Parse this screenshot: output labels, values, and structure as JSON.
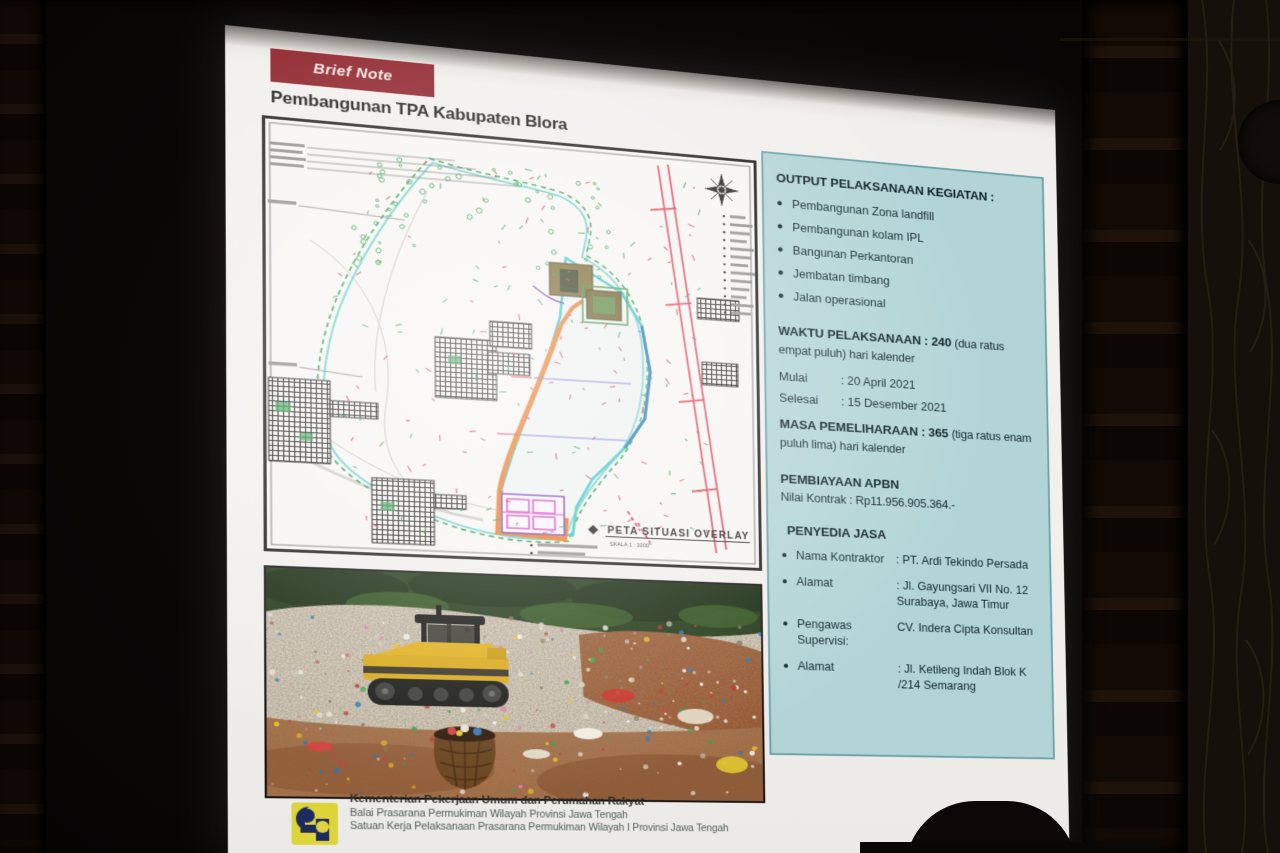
{
  "slide": {
    "badge_label": "Brief Note",
    "title": "Pembangunan TPA Kabupaten Blora",
    "map": {
      "caption": "PETA SITUASI OVERLAY",
      "scale": "SKALA 1 : 1000"
    },
    "panel": {
      "output": {
        "heading": "OUTPUT PELAKSANAAN KEGIATAN :",
        "items": [
          "Pembangunan Zona landfill",
          "Pembangunan kolam IPL",
          "Bangunan Perkantoran",
          "Jembatan timbang",
          "Jalan operasional"
        ]
      },
      "schedule": {
        "waktu_label": "WAKTU PELAKSANAAN :",
        "waktu_number": "240",
        "waktu_note": "(dua ratus empat puluh) hari kalender",
        "rows": [
          {
            "label": "Mulai",
            "value": ": 20 April 2021"
          },
          {
            "label": "Selesai",
            "value": ": 15 Desember 2021"
          }
        ],
        "masa_label": "MASA PEMELIHARAAN :",
        "masa_number": "365",
        "masa_note": "(tiga ratus enam puluh lima) hari kalender"
      },
      "funding": {
        "heading": "PEMBIAYAAN APBN",
        "row_label": "Nilai Kontrak",
        "row_value": ": Rp11.956.905.364.-"
      },
      "provider": {
        "heading": "PENYEDIA JASA",
        "rows": [
          {
            "label": "Nama Kontraktor",
            "value": ": PT. Ardi Tekindo Persada"
          },
          {
            "label": "Alamat",
            "value": ": Jl. Gayungsari VII No. 12 Surabaya, Jawa Timur"
          },
          {
            "label": "Pengawas Supervisi:",
            "value": "CV. Indera Cipta Konsultan"
          },
          {
            "label": "Alamat",
            "value": ": Jl. Ketileng Indah Blok K /214 Semarang"
          }
        ]
      }
    },
    "footer": {
      "org_line1": "Kementerian Pekerjaan Umum dan Perumahan Rakyat",
      "org_line2": "Balai Prasarana Permukiman Wilayah Provinsi Jawa Tengah",
      "org_line3": "Satuan Kerja Pelaksanaan Prasarana Permukiman Wilayah I Provinsi Jawa Tengah"
    },
    "colors": {
      "badge_maroon": "#8a1a22",
      "panel_teal_bg": "#b2d4d6",
      "panel_teal_border": "#6ba3ab",
      "logo_yellow": "#ded43a",
      "logo_navy": "#1d2a5e"
    }
  }
}
